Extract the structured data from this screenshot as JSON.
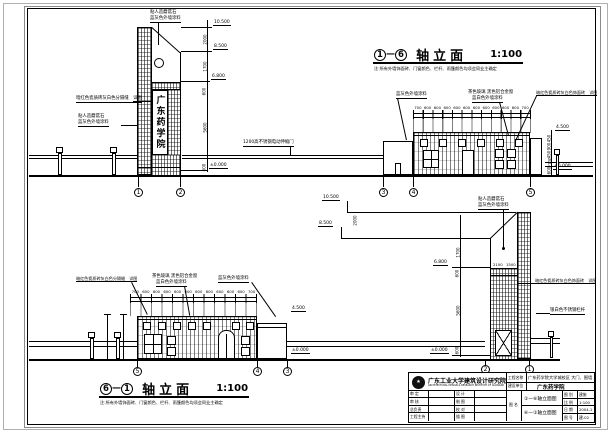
{
  "drawing": {
    "bg": "#ffffff",
    "line_color": "#000000"
  },
  "tower_sign": "广东药学院",
  "notes": {
    "top": "注:所有外墙饰面砖、门窗颜色、栏杆、雨篷颜色均须会同业主确定",
    "bottom": "注:所有外墙饰面砖、门窗颜色、栏杆、雨篷颜色均须会同业主确定"
  },
  "titles": {
    "top": {
      "from": "1",
      "to": "6",
      "dash": "—",
      "name": "轴立面",
      "scale": "1:100"
    },
    "bottom": {
      "from": "6",
      "to": "1",
      "dash": "—",
      "name": "轴立面",
      "scale": "1:100"
    }
  },
  "top_elev": {
    "axes": [
      "1",
      "2",
      "3",
      "4",
      "5"
    ],
    "tower": {
      "flags": [
        "10.500",
        "8.500",
        "6.800",
        "±0.000"
      ],
      "chain": [
        "2000",
        "1700",
        "600",
        "5600",
        "600"
      ],
      "cap_label": [
        "贴人造蘑菇石",
        "蓝灰色外墙涂料"
      ],
      "mid_label": "暗红色瓷质砖灰白色分隔缝　详图",
      "low_label": [
        "贴人造蘑菇石",
        "蓝灰色外墙涂料"
      ]
    },
    "gate_note": "1200高不锈钢电动伸缩门",
    "building": {
      "chain": [
        "700",
        "600",
        "600",
        "600",
        "600",
        "600",
        "600",
        "600",
        "600",
        "600",
        "600",
        "700"
      ],
      "label_left": "蓝灰色外墙涂料",
      "label_mid": [
        "茶色玻璃 黑色铝合金窗",
        "蓝白色外墙涂料"
      ],
      "label_right": "暗红色瓷质砖灰白色饰面砖　详图",
      "side_flags": [
        "4.500",
        "±0.000"
      ],
      "side_chain": [
        "450",
        "900",
        "450",
        "2100",
        "600"
      ]
    }
  },
  "bottom_elev": {
    "axes": [
      "5",
      "4",
      "3",
      "2",
      "1"
    ],
    "building": {
      "chain": [
        "700",
        "600",
        "600",
        "600",
        "600",
        "600",
        "600",
        "600",
        "600",
        "600",
        "600",
        "700"
      ],
      "label_left": "暗红色瓷质砖灰白色分隔缝　详图",
      "label_mid": [
        "茶色玻璃 黑色铝合金窗",
        "蓝白色外墙涂料"
      ],
      "label_right": "蓝灰色外墙涂料",
      "annex_flags": [
        "4.500",
        "±0.000"
      ]
    },
    "tower": {
      "peak_flags": [
        "10.500",
        "8.500"
      ],
      "left_flags": [
        "6.800",
        "±0.000"
      ],
      "chain": [
        "2000",
        "1700",
        "600",
        "5600",
        "600"
      ],
      "band_dims": [
        "2100",
        "1500"
      ],
      "cap_label": [
        "贴人造蘑菇石",
        "蓝灰色外墙涂料"
      ],
      "label_right": "暗红色瓷质砖灰白色饰面砖　详图",
      "label_rail": "银白色不锈钢栏杆"
    }
  },
  "titleblock": {
    "institute": "广东工业大学建筑设计研究院",
    "institute_en": "ARCHITECTURAL DESIGN & RESEARCH INSTITUTE OF GUANGDONG UNIVERSITY OF TECHNOLOGY",
    "roles": [
      {
        "label": "审 定",
        "value": ""
      },
      {
        "label": "审 核",
        "value": ""
      },
      {
        "label": "总负责",
        "value": ""
      },
      {
        "label": "工程主持",
        "value": ""
      }
    ],
    "roles2": [
      {
        "label": "设 计",
        "value": ""
      },
      {
        "label": "制 图",
        "value": ""
      },
      {
        "label": "校 对",
        "value": ""
      },
      {
        "label": "描 图",
        "value": ""
      }
    ],
    "project_label": "工程名称",
    "project": "广东药学院大学城校区 大门、围墙",
    "client_label": "建设单位",
    "client": "广东药学院",
    "drawing_label": "图 名",
    "drawings": [
      "①—⑥轴立面图",
      "⑥—①轴立面图"
    ],
    "meta": [
      {
        "label": "图 别",
        "value": "建施"
      },
      {
        "label": "比 例",
        "value": "1:100"
      },
      {
        "label": "日 期",
        "value": "2004.1"
      },
      {
        "label": "图 号",
        "value": "建-02"
      }
    ]
  }
}
